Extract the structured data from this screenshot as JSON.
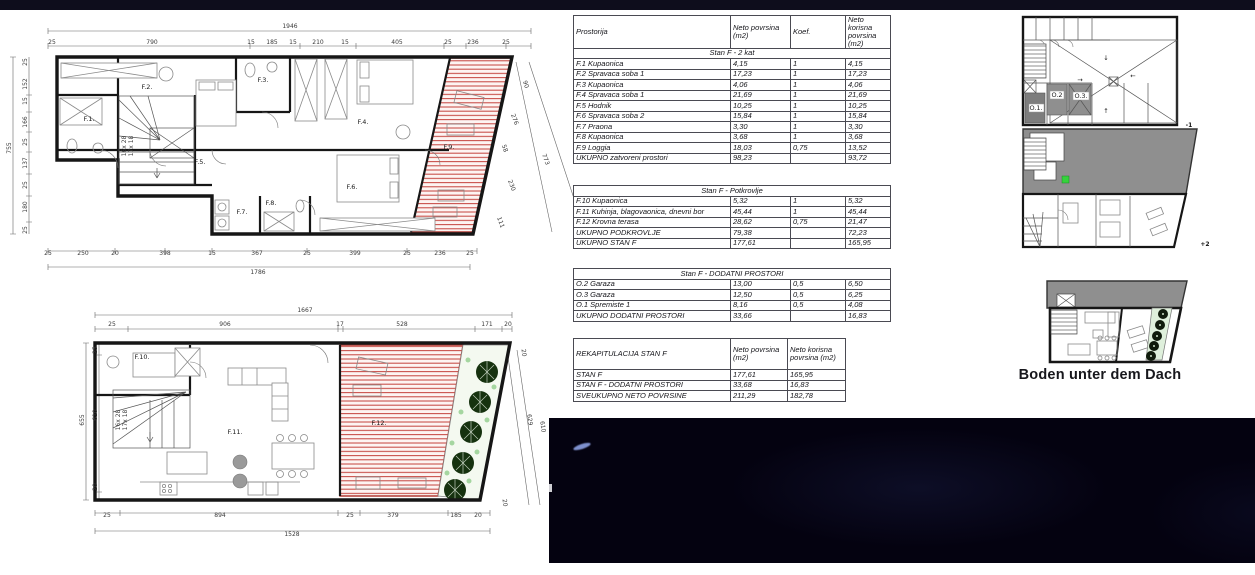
{
  "colors": {
    "top_bar": "#0e0d1c",
    "photo_background": "#040210",
    "terrace_hatch_red": "#c4423b",
    "other_unit_gray": "#8f8f8f",
    "tree_dark_green": "#16320f",
    "tree_light_green": "#a5d6a0",
    "wall_black": "#161616"
  },
  "area_table": {
    "col_headers": [
      "Prostorija",
      "Neto povrsina (m2)",
      "Koef.",
      "Neto korisna povrsina (m2)"
    ],
    "sections": {
      "level2": {
        "title": "Stan F - 2 kat",
        "rows": [
          [
            "F.1 Kupaonica",
            "4,15",
            "1",
            "4,15"
          ],
          [
            "F.2 Spravaca soba 1",
            "17,23",
            "1",
            "17,23"
          ],
          [
            "F.3 Kupaonica",
            "4,06",
            "1",
            "4,06"
          ],
          [
            "F.4 Spravaca soba 1",
            "21,69",
            "1",
            "21,69"
          ],
          [
            "F.5 Hodnik",
            "10,25",
            "1",
            "10,25"
          ],
          [
            "F.6 Spravaca soba 2",
            "15,84",
            "1",
            "15,84"
          ],
          [
            "F.7 Praona",
            "3,30",
            "1",
            "3,30"
          ],
          [
            "F.8 Kupaonica",
            "3,68",
            "1",
            "3,68"
          ],
          [
            "F.9 Loggia",
            "18,03",
            "0,75",
            "13,52"
          ],
          [
            "UKUPNO zatvoreni prostori",
            "98,23",
            "",
            "93,72"
          ]
        ]
      },
      "attic": {
        "title": "Stan F - Potkrovlje",
        "rows": [
          [
            "F.10 Kupaonica",
            "5,32",
            "1",
            "5,32"
          ],
          [
            "F.11 Kuhinja, blagovaonica, dnevni bor",
            "45,44",
            "1",
            "45,44"
          ],
          [
            "F.12 Krovna terasa",
            "28,62",
            "0,75",
            "21,47"
          ],
          [
            "UKUPNO PODKROVLJE",
            "79,38",
            "",
            "72,23"
          ],
          [
            "UKUPNO STAN F",
            "177,61",
            "",
            "165,95"
          ]
        ]
      },
      "additional": {
        "title": "Stan F - DODATNI PROSTORI",
        "rows": [
          [
            "O.2 Garaza",
            "13,00",
            "0,5",
            "6,50"
          ],
          [
            "O.3 Garaza",
            "12,50",
            "0,5",
            "6,25"
          ],
          [
            "O.1 Spremiste 1",
            "8,16",
            "0,5",
            "4,08"
          ],
          [
            "UKUPNO DODATNI PROSTORI",
            "33,66",
            "",
            "16,83"
          ]
        ]
      }
    },
    "rekap": {
      "row_label": "REKAPITULACIJA STAN F",
      "col_headers": [
        "Neto povrsina (m2)",
        "Neto korisna povrsina (m2)"
      ],
      "rows": [
        [
          "STAN F",
          "177,61",
          "165,95"
        ],
        [
          "STAN F - DODATNI PROSTORI",
          "33,68",
          "16,83"
        ],
        [
          "SVEUKUPNO NETO POVRSINE",
          "211,29",
          "182,78"
        ]
      ]
    }
  },
  "plan_upper": {
    "room_labels": [
      {
        "t": "F.1.",
        "x": 89,
        "y": 121
      },
      {
        "t": "F.2.",
        "x": 147,
        "y": 89
      },
      {
        "t": "F.3.",
        "x": 263,
        "y": 82
      },
      {
        "t": "F.4.",
        "x": 363,
        "y": 124
      },
      {
        "t": "F.5.",
        "x": 200,
        "y": 164
      },
      {
        "t": "F.6.",
        "x": 352,
        "y": 189
      },
      {
        "t": "F.7.",
        "x": 242,
        "y": 214
      },
      {
        "t": "F.8.",
        "x": 271,
        "y": 205
      },
      {
        "t": "F.9.",
        "x": 449,
        "y": 149
      }
    ],
    "stair_notes": [
      {
        "t": "16x 28",
        "x": 126,
        "y": 146,
        "r": -90,
        "s": 4.5
      },
      {
        "t": "17x 18",
        "x": 133,
        "y": 146,
        "r": -90,
        "s": 4.5
      }
    ],
    "dims": [
      {
        "t": "1946",
        "x": 290,
        "y": 28
      },
      {
        "t": "25",
        "x": 52,
        "y": 44
      },
      {
        "t": "790",
        "x": 152,
        "y": 44
      },
      {
        "t": "15",
        "x": 251,
        "y": 44
      },
      {
        "t": "185",
        "x": 272,
        "y": 44
      },
      {
        "t": "15",
        "x": 293,
        "y": 44
      },
      {
        "t": "210",
        "x": 318,
        "y": 44
      },
      {
        "t": "15",
        "x": 345,
        "y": 44
      },
      {
        "t": "405",
        "x": 397,
        "y": 44
      },
      {
        "t": "25",
        "x": 448,
        "y": 44
      },
      {
        "t": "236",
        "x": 473,
        "y": 44
      },
      {
        "t": "25",
        "x": 506,
        "y": 44
      },
      {
        "t": "755",
        "x": 11,
        "y": 148,
        "r": -90
      },
      {
        "t": "25",
        "x": 27,
        "y": 62,
        "r": -90
      },
      {
        "t": "152",
        "x": 27,
        "y": 84,
        "r": -90
      },
      {
        "t": "15",
        "x": 27,
        "y": 101,
        "r": -90
      },
      {
        "t": "166",
        "x": 27,
        "y": 122,
        "r": -90
      },
      {
        "t": "25",
        "x": 27,
        "y": 142,
        "r": -90
      },
      {
        "t": "137",
        "x": 27,
        "y": 163,
        "r": -90
      },
      {
        "t": "25",
        "x": 27,
        "y": 185,
        "r": -90
      },
      {
        "t": "180",
        "x": 27,
        "y": 207,
        "r": -90
      },
      {
        "t": "25",
        "x": 27,
        "y": 230,
        "r": -90
      },
      {
        "t": "25",
        "x": 48,
        "y": 255
      },
      {
        "t": "250",
        "x": 83,
        "y": 255
      },
      {
        "t": "20",
        "x": 115,
        "y": 255
      },
      {
        "t": "398",
        "x": 165,
        "y": 255
      },
      {
        "t": "15",
        "x": 212,
        "y": 255
      },
      {
        "t": "367",
        "x": 257,
        "y": 255
      },
      {
        "t": "25",
        "x": 307,
        "y": 255
      },
      {
        "t": "399",
        "x": 355,
        "y": 255
      },
      {
        "t": "25",
        "x": 407,
        "y": 255
      },
      {
        "t": "236",
        "x": 440,
        "y": 255
      },
      {
        "t": "25",
        "x": 470,
        "y": 255
      },
      {
        "t": "1786",
        "x": 258,
        "y": 274
      },
      {
        "t": "90",
        "x": 524,
        "y": 85,
        "r": 70
      },
      {
        "t": "276",
        "x": 513,
        "y": 120,
        "r": 70
      },
      {
        "t": "58",
        "x": 503,
        "y": 149,
        "r": 70
      },
      {
        "t": "230",
        "x": 510,
        "y": 186,
        "r": 70
      },
      {
        "t": "111",
        "x": 499,
        "y": 223,
        "r": 70
      },
      {
        "t": "773",
        "x": 544,
        "y": 160,
        "r": 70
      }
    ]
  },
  "plan_lower": {
    "room_labels": [
      {
        "t": "F.10.",
        "x": 142,
        "y": 359
      },
      {
        "t": "F.11.",
        "x": 235,
        "y": 434
      },
      {
        "t": "F.12.",
        "x": 379,
        "y": 425
      }
    ],
    "stair_notes": [
      {
        "t": "16x 28",
        "x": 120,
        "y": 420,
        "r": -90,
        "s": 4.5
      },
      {
        "t": "17x 18",
        "x": 127,
        "y": 420,
        "r": -90,
        "s": 4.5
      }
    ],
    "dims": [
      {
        "t": "1667",
        "x": 305,
        "y": 312
      },
      {
        "t": "25",
        "x": 112,
        "y": 326
      },
      {
        "t": "906",
        "x": 225,
        "y": 326
      },
      {
        "t": "17",
        "x": 340,
        "y": 326
      },
      {
        "t": "528",
        "x": 402,
        "y": 326
      },
      {
        "t": "171",
        "x": 487,
        "y": 326
      },
      {
        "t": "20",
        "x": 508,
        "y": 326
      },
      {
        "t": "655",
        "x": 84,
        "y": 420,
        "r": -90
      },
      {
        "t": "25",
        "x": 97,
        "y": 350,
        "r": -90
      },
      {
        "t": "610",
        "x": 97,
        "y": 415,
        "r": -90
      },
      {
        "t": "20",
        "x": 97,
        "y": 487,
        "r": -90
      },
      {
        "t": "25",
        "x": 107,
        "y": 517
      },
      {
        "t": "894",
        "x": 220,
        "y": 517
      },
      {
        "t": "25",
        "x": 350,
        "y": 517
      },
      {
        "t": "379",
        "x": 393,
        "y": 517
      },
      {
        "t": "185",
        "x": 456,
        "y": 517
      },
      {
        "t": "20",
        "x": 478,
        "y": 517
      },
      {
        "t": "1528",
        "x": 292,
        "y": 536
      },
      {
        "t": "20",
        "x": 522,
        "y": 353,
        "r": 82
      },
      {
        "t": "629",
        "x": 528,
        "y": 420,
        "r": 82
      },
      {
        "t": "610",
        "x": 541,
        "y": 427,
        "r": 82
      },
      {
        "t": "20",
        "x": 503,
        "y": 503,
        "r": 82
      }
    ]
  },
  "plan_minus1": {
    "room_labels": [
      {
        "t": "O.1.",
        "x": 1036,
        "y": 110,
        "s": 5.5
      },
      {
        "t": "O.2",
        "x": 1057,
        "y": 97,
        "s": 5.5
      },
      {
        "t": "O.3.",
        "x": 1081,
        "y": 98,
        "s": 5.5
      }
    ],
    "arrows": [
      {
        "t": "↓",
        "x": 1106,
        "y": 60,
        "s": 9
      },
      {
        "t": "→",
        "x": 1080,
        "y": 82,
        "s": 8
      },
      {
        "t": "←",
        "x": 1133,
        "y": 78,
        "s": 8
      },
      {
        "t": "↑",
        "x": 1106,
        "y": 113,
        "s": 9
      }
    ]
  },
  "level_labels": [
    {
      "t": "-1",
      "x": 1189,
      "y": 127,
      "s": 10,
      "w": "bold"
    },
    {
      "t": "+2",
      "x": 1205,
      "y": 246,
      "s": 11,
      "w": "bold"
    }
  ],
  "right_plans": {
    "attic_caption": "Boden unter dem Dach"
  }
}
